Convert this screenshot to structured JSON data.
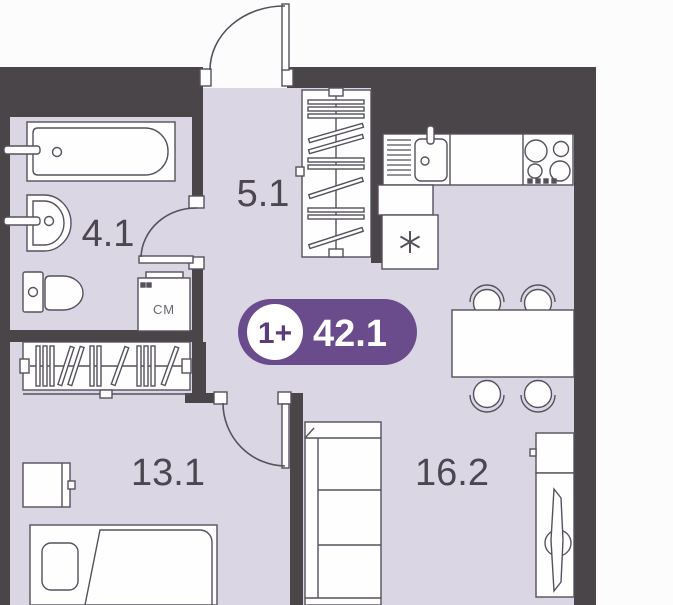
{
  "floorplan": {
    "badge": {
      "rooms": "1+",
      "total_area": "42.1"
    },
    "rooms": [
      {
        "name": "bathroom",
        "area": "4.1"
      },
      {
        "name": "hallway",
        "area": "5.1"
      },
      {
        "name": "bedroom",
        "area": "13.1"
      },
      {
        "name": "living-kitchen",
        "area": "16.2"
      }
    ],
    "labels": {
      "washing_machine": "СМ"
    },
    "colors": {
      "walls": "#4a4549",
      "floor": "#dad6e3",
      "background": "#fdfcfd",
      "furniture_fill": "#fefefe",
      "furniture_outline": "#56515c",
      "badge": "#6a4c8c",
      "badge_text": "#ffffff",
      "badge_circle_fill": "#ffffff",
      "badge_circle_text": "#5b3d7e",
      "room_label": "#4b4650",
      "appliance_label": "#6a6570"
    }
  }
}
